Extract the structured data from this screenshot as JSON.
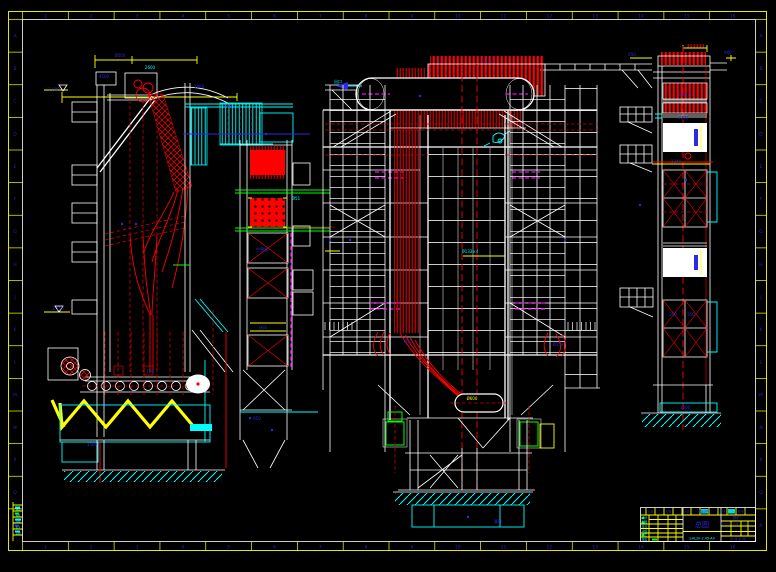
{
  "sheet": {
    "description": "CAD general arrangement drawing of an industrial boiler, three elevation views on black background",
    "background": "#000000"
  },
  "colors": {
    "frame_yellow": "#ffff00",
    "frame_white": "#ffffff",
    "line_red": "#ff0000",
    "line_cyan": "#00ffff",
    "line_green": "#00ff00",
    "line_magenta": "#ff00ff",
    "text_blue": "#2b2be0"
  },
  "border": {
    "top_labels": [
      "1",
      "2",
      "3",
      "4",
      "5",
      "6",
      "7",
      "8",
      "9",
      "10",
      "11",
      "12",
      "13",
      "14",
      "15",
      "16"
    ],
    "bottom_labels": [
      "1",
      "2",
      "3",
      "4",
      "5",
      "6",
      "7",
      "8",
      "9",
      "10",
      "11",
      "12",
      "13",
      "14",
      "15",
      "16"
    ],
    "left_labels": [
      "A",
      "B",
      "C",
      "D",
      "E",
      "F",
      "G",
      "H",
      "J",
      "K",
      "L",
      "M",
      "N",
      "P",
      "Q",
      "R"
    ],
    "right_labels": [
      "A",
      "B",
      "C",
      "D",
      "E",
      "F",
      "G",
      "H",
      "J",
      "K",
      "L",
      "M",
      "N",
      "P",
      "Q",
      "R"
    ]
  },
  "view_labels": [
    {
      "x": 440,
      "y": 63,
      "t": "I—I"
    },
    {
      "x": 487,
      "y": 63,
      "t": "II—II"
    }
  ],
  "annotations": [
    {
      "x": 104,
      "y": 78,
      "c": "b",
      "t": "4500"
    },
    {
      "x": 150,
      "y": 69,
      "c": "c",
      "t": "2600"
    },
    {
      "x": 199,
      "y": 88,
      "c": "b",
      "t": "1800"
    },
    {
      "x": 228,
      "y": 108,
      "c": "b",
      "t": "700"
    },
    {
      "x": 120,
      "y": 57,
      "c": "b",
      "t": "Ø500"
    },
    {
      "x": 262,
      "y": 251,
      "c": "b",
      "t": "空预器"
    },
    {
      "x": 263,
      "y": 329,
      "c": "b",
      "t": "送风"
    },
    {
      "x": 150,
      "y": 373,
      "c": "b",
      "t": "750"
    },
    {
      "x": 92,
      "y": 446,
      "c": "b",
      "t": "1500"
    },
    {
      "x": 54,
      "y": 91,
      "c": "b",
      "t": "7.000"
    },
    {
      "x": 58,
      "y": 310,
      "c": "b",
      "t": "3.150"
    },
    {
      "x": 296,
      "y": 200,
      "c": "c",
      "t": "Ø51"
    },
    {
      "x": 338,
      "y": 83,
      "c": "c",
      "t": "出口"
    },
    {
      "x": 470,
      "y": 253,
      "c": "c",
      "t": "Ø133×4"
    },
    {
      "x": 498,
      "y": 523,
      "c": "b",
      "t": "基础"
    },
    {
      "x": 408,
      "y": 343,
      "c": "b",
      "t": "Ø51"
    },
    {
      "x": 558,
      "y": 346,
      "c": "b",
      "t": "Ø159"
    },
    {
      "x": 632,
      "y": 56,
      "c": "b",
      "t": "650"
    },
    {
      "x": 728,
      "y": 54,
      "c": "b",
      "t": "900"
    },
    {
      "x": 472,
      "y": 400,
      "c": "y",
      "t": "Ø600"
    },
    {
      "x": 686,
      "y": 96,
      "c": "b",
      "t": "Ø51×3"
    },
    {
      "x": 683,
      "y": 119,
      "c": "b",
      "t": "1200"
    },
    {
      "x": 676,
      "y": 163,
      "c": "b",
      "t": "2240"
    },
    {
      "x": 673,
      "y": 316,
      "c": "b",
      "t": "350"
    },
    {
      "x": 691,
      "y": 316,
      "c": "b",
      "t": "350"
    },
    {
      "x": 685,
      "y": 409,
      "c": "b",
      "t": "1600"
    },
    {
      "x": 257,
      "y": 420,
      "c": "b",
      "t": "650"
    }
  ],
  "title_block": {
    "revision_row": [
      "标记",
      "处数",
      "分区",
      "更改文件号",
      "签名",
      "年月日"
    ],
    "left_rows": [
      "设计",
      "制图",
      "校对",
      "审核",
      "工艺",
      "批准"
    ],
    "title": "总图",
    "drawing_no": "SHL20-2.45-AII",
    "company": "锅炉厂",
    "right_headers": [
      "阶段标记",
      "质量",
      "比例"
    ],
    "sheet_note": "共1张 第1张"
  },
  "corner_block_rows": [
    "描图",
    "描校",
    "底图",
    "签字",
    "日期"
  ]
}
